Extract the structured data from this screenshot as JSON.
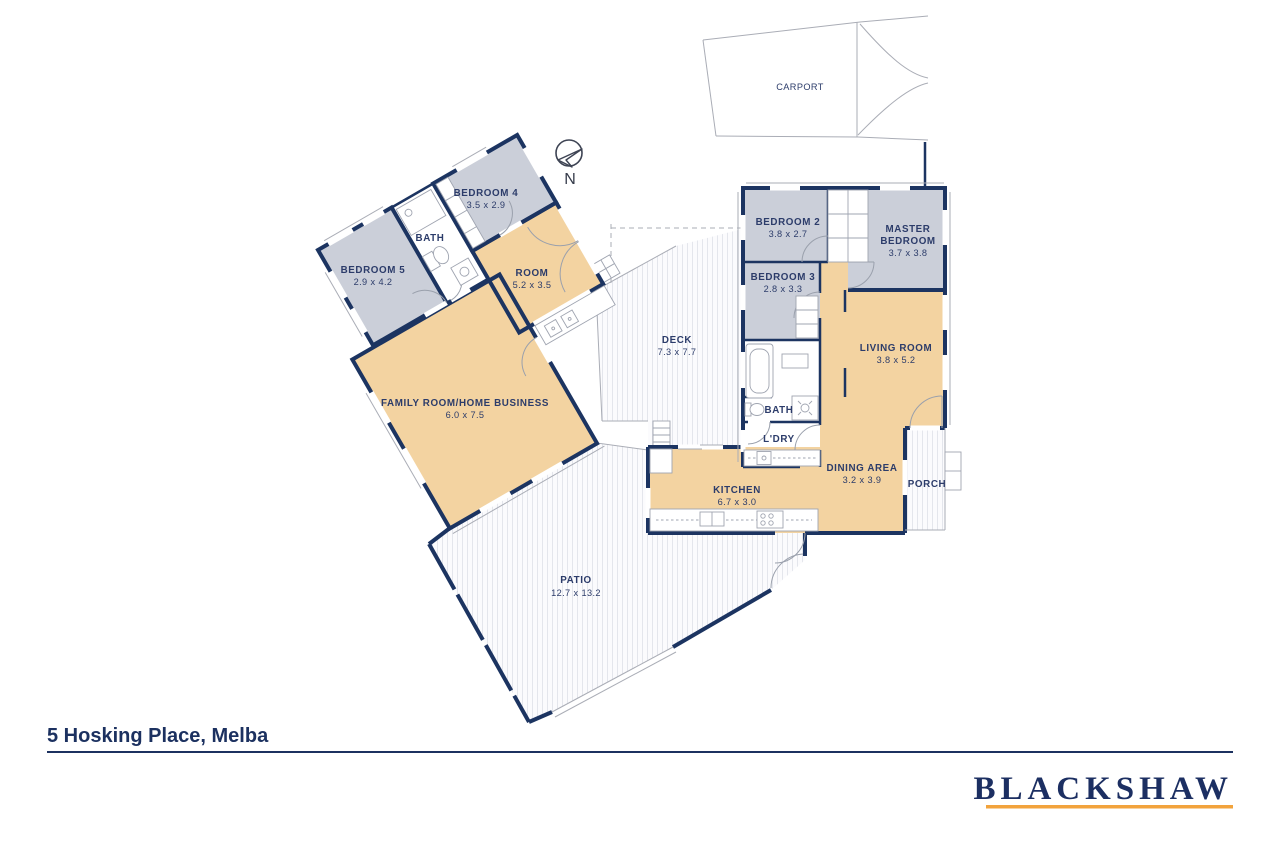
{
  "title": "5 Hosking Place, Melba",
  "brand": {
    "name": "BLACKSHAW"
  },
  "compass": {
    "label": "N"
  },
  "colors": {
    "wall": "#1c3461",
    "room-gray": "#cbcfd9",
    "room-tan": "#f3d3a1",
    "stripe": "#e4e6ec",
    "text": "#2c3c6a",
    "gold": "#F2A33C",
    "title": "#1c3160",
    "logo": "#1c2f62"
  },
  "rooms": {
    "carport": {
      "name": "CARPORT"
    },
    "bedroom4": {
      "name": "BEDROOM 4",
      "dims": "3.5 x 2.9"
    },
    "bath1": {
      "name": "BATH"
    },
    "bedroom5": {
      "name": "BEDROOM 5",
      "dims": "2.9 x 4.2"
    },
    "room": {
      "name": "ROOM",
      "dims": "5.2 x 3.5"
    },
    "family": {
      "name": "FAMILY ROOM/HOME BUSINESS",
      "dims": "6.0 x 7.5"
    },
    "deck": {
      "name": "DECK",
      "dims": "7.3 x 7.7"
    },
    "bedroom2": {
      "name": "BEDROOM 2",
      "dims": "3.8 x 2.7"
    },
    "master": {
      "name1": "MASTER",
      "name2": "BEDROOM",
      "dims": "3.7 x 3.8"
    },
    "bedroom3": {
      "name": "BEDROOM 3",
      "dims": "2.8 x 3.3"
    },
    "living": {
      "name": "LIVING ROOM",
      "dims": "3.8 x 5.2"
    },
    "bath2": {
      "name": "BATH"
    },
    "laundry": {
      "name": "L'DRY"
    },
    "dining": {
      "name": "DINING AREA",
      "dims": "3.2 x 3.9"
    },
    "kitchen": {
      "name": "KITCHEN",
      "dims": "6.7 x 3.0"
    },
    "porch": {
      "name": "PORCH"
    },
    "patio": {
      "name": "PATIO",
      "dims": "12.7 x 13.2"
    }
  }
}
